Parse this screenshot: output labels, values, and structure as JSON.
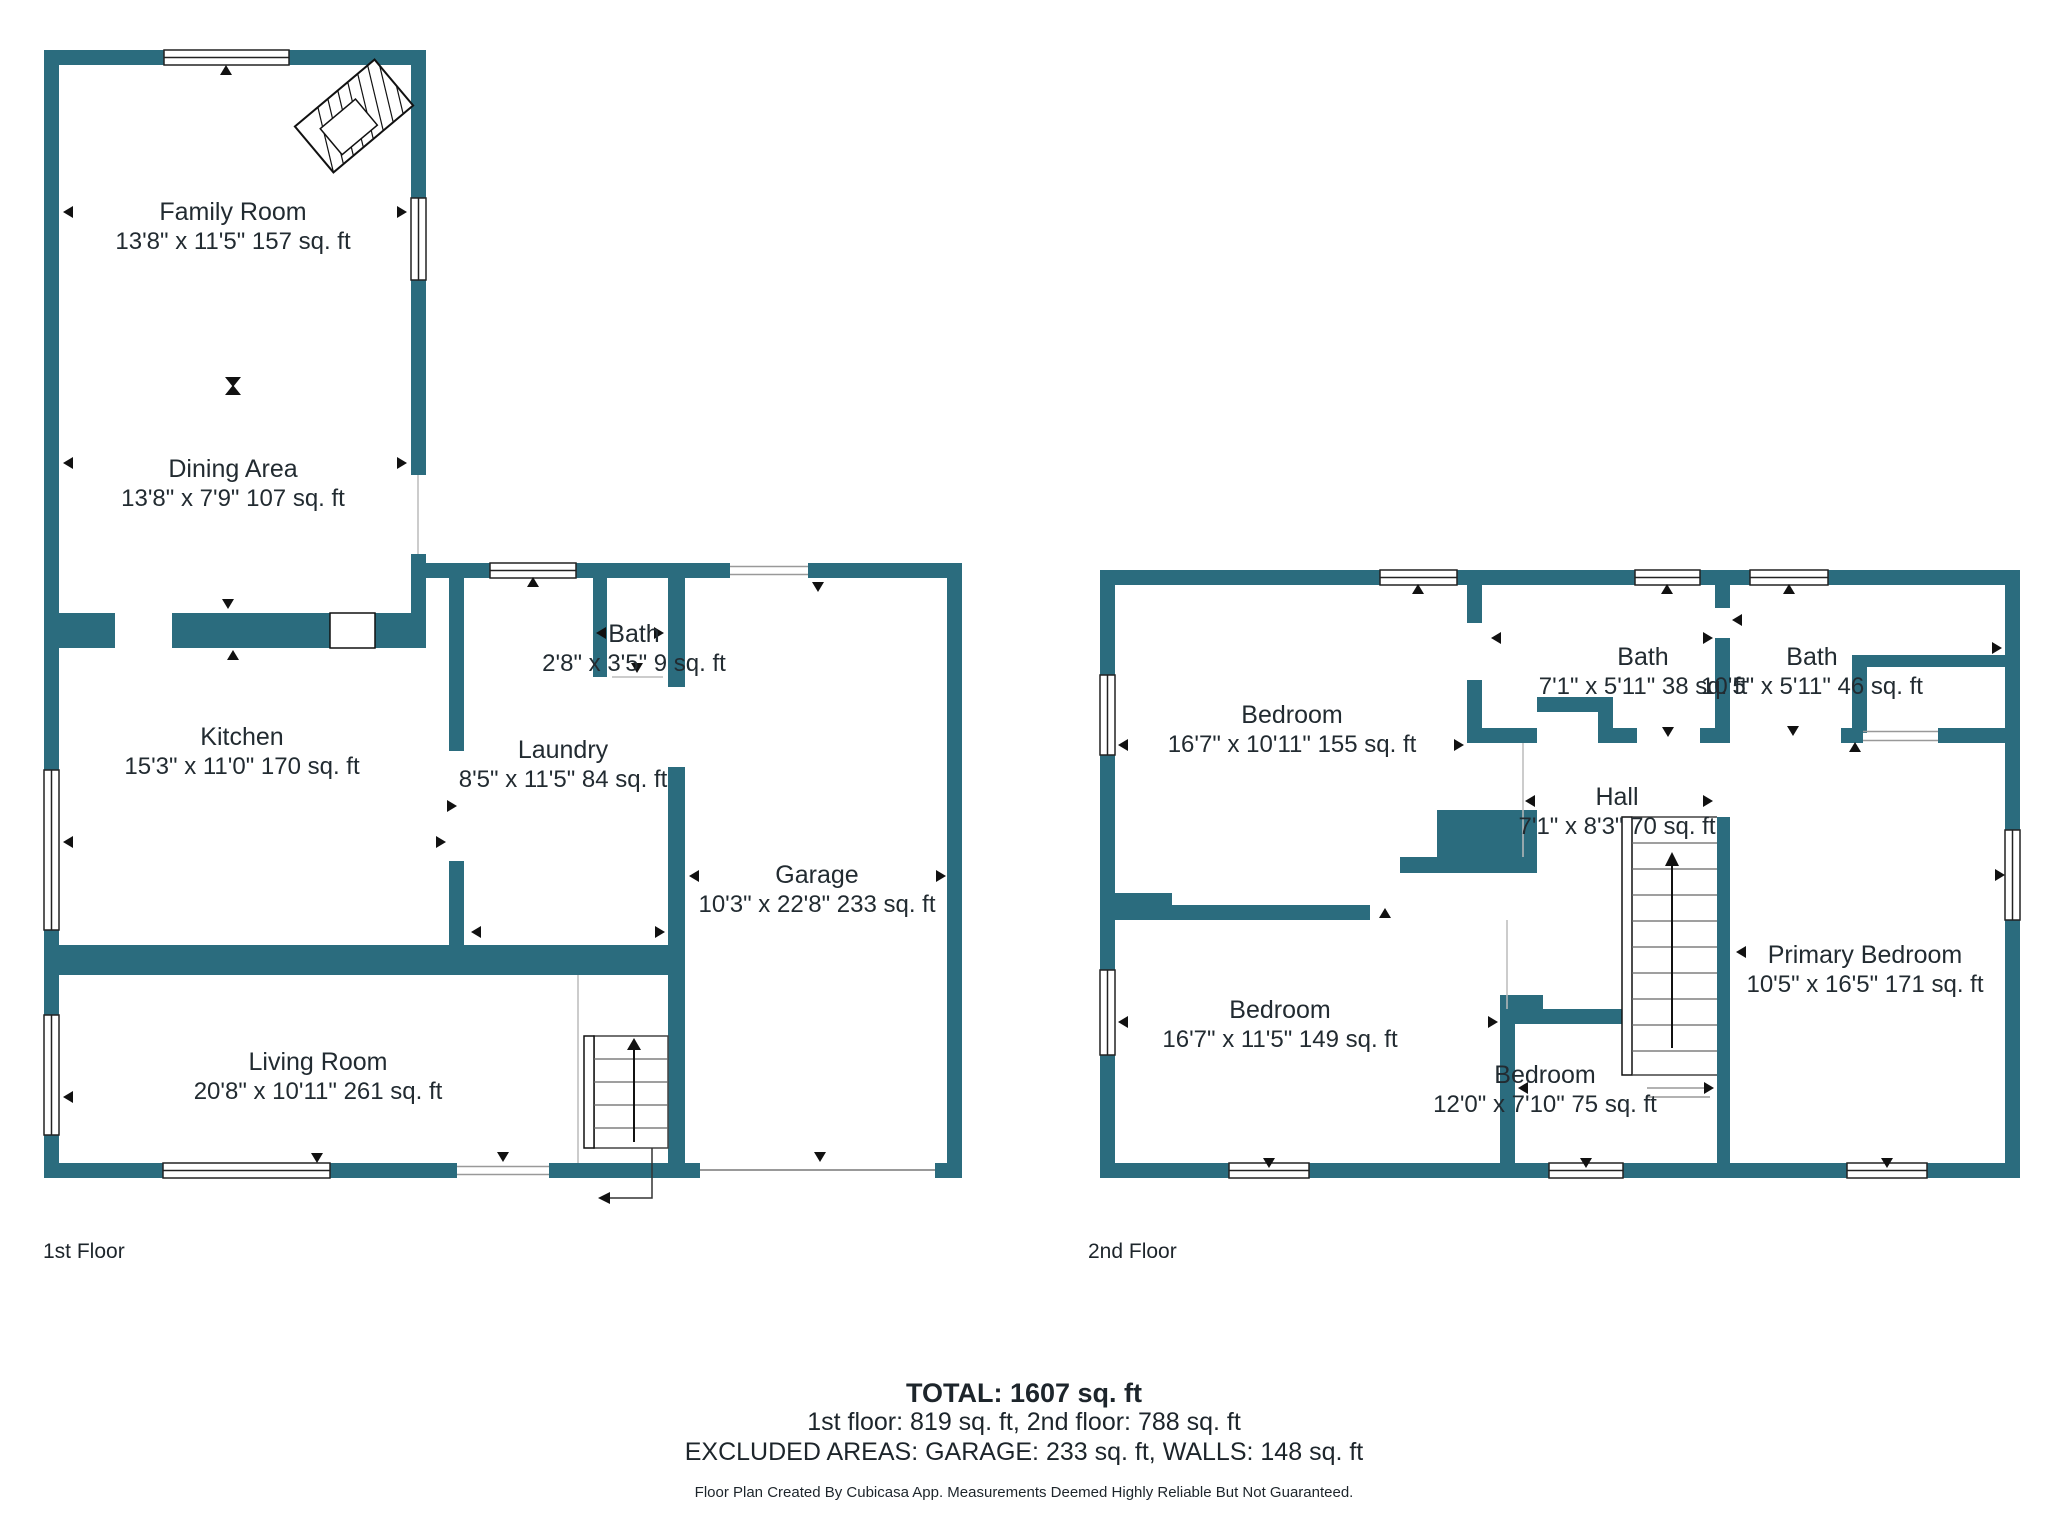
{
  "colors": {
    "wall": "#2B6C7E",
    "text": "#222B31"
  },
  "floor1": {
    "label": "1st Floor",
    "rooms": [
      {
        "name": "Family Room",
        "dims": "13'8\" x 11'5\" 157 sq. ft"
      },
      {
        "name": "Dining Area",
        "dims": "13'8\" x 7'9\" 107 sq. ft"
      },
      {
        "name": "Kitchen",
        "dims": "15'3\" x 11'0\" 170 sq. ft"
      },
      {
        "name": "Bath",
        "dims": "2'8\" x 3'5\" 9 sq. ft"
      },
      {
        "name": "Laundry",
        "dims": "8'5\" x 11'5\" 84 sq. ft"
      },
      {
        "name": "Garage",
        "dims": "10'3\" x 22'8\" 233 sq. ft"
      },
      {
        "name": "Living Room",
        "dims": "20'8\" x 10'11\" 261 sq. ft"
      }
    ]
  },
  "floor2": {
    "label": "2nd Floor",
    "rooms": [
      {
        "name": "Bedroom",
        "dims": "16'7\" x 10'11\" 155 sq. ft"
      },
      {
        "name": "Bath",
        "dims": "7'1\" x 5'11\" 38 sq. ft"
      },
      {
        "name": "Bath",
        "dims": "10'5\" x 5'11\" 46 sq. ft"
      },
      {
        "name": "Hall",
        "dims": "7'1\" x 8'3\" 70 sq. ft"
      },
      {
        "name": "Bedroom",
        "dims": "16'7\" x 11'5\" 149 sq. ft"
      },
      {
        "name": "Bedroom",
        "dims": "12'0\" x 7'10\" 75 sq. ft"
      },
      {
        "name": "Primary Bedroom",
        "dims": "10'5\" x 16'5\" 171 sq. ft"
      }
    ]
  },
  "summary": {
    "total": "TOTAL: 1607 sq. ft",
    "floors": "1st floor: 819 sq. ft, 2nd floor: 788 sq. ft",
    "excluded": "EXCLUDED AREAS: GARAGE: 233 sq. ft, WALLS: 148 sq. ft",
    "disclaimer": "Floor Plan Created By Cubicasa App. Measurements Deemed Highly Reliable But Not Guaranteed."
  }
}
